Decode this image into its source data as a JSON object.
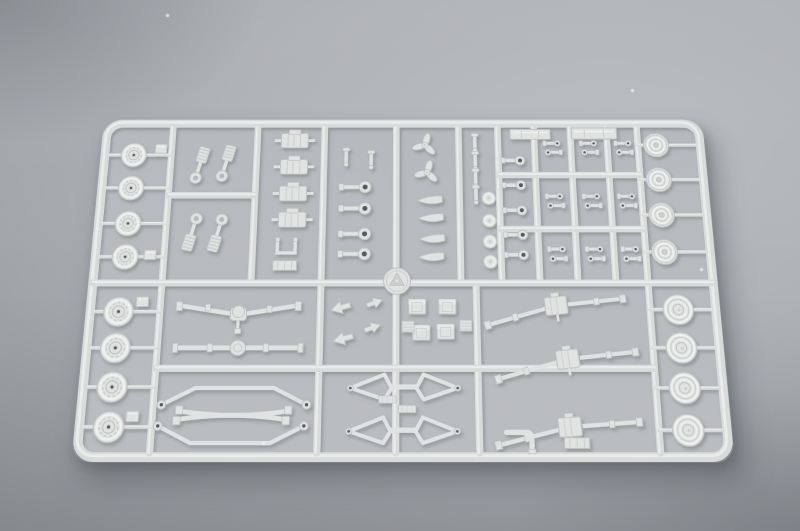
{
  "photo": {
    "description": "Light grey injection-moulded plastic model-kit sprue photographed at a slight angle on a grey studio surface; the runner frame holds columns of road wheels along both edges and rows of suspension parts: coil-spring shock absorbers, gearbox blocks, linkage arms, propeller and blade pieces, discs, clevis fittings, drive axles with differentials, leaf-spring assemblies, wishbone lattices, transfer cases and small stowage boxes, with a round medallion part at the centre junction.",
    "background": {
      "highlight": "#b8bbbf",
      "mid": "#aeb1b6",
      "low": "#a2a5aa",
      "dark": "#92959a"
    },
    "plastic": {
      "base": "#e0e3e1",
      "light": "#eff1ef",
      "mid": "#cdd0ce",
      "shade": "#c0c3c1",
      "hole": "#555860",
      "runner": "#d8dbd9",
      "runner_highlight": "#ecefec",
      "interior_top": "#b6b9bd",
      "interior_bottom": "#babdc0",
      "shadow": "#70747a"
    },
    "specks": [
      {
        "x": 166,
        "y": 14
      },
      {
        "x": 631,
        "y": 89
      },
      {
        "x": 262,
        "y": 442
      },
      {
        "x": 700,
        "y": 268
      }
    ]
  },
  "sprue": {
    "frame": {
      "x": 5,
      "y": 5,
      "width": 620,
      "height": 340,
      "radius": 16,
      "thickness": 9
    },
    "runner_width": 7,
    "gate_width": 3.5,
    "runners": {
      "vertical": [
        {
          "x": 74,
          "y1": 9,
          "y2": 341
        },
        {
          "x": 233,
          "y1": 9,
          "y2": 341
        },
        {
          "x": 308,
          "y1": 9,
          "y2": 341
        },
        {
          "x": 560,
          "y1": 9,
          "y2": 341
        },
        {
          "x": 163,
          "y1": 9,
          "y2": 176
        },
        {
          "x": 373,
          "y1": 9,
          "y2": 176
        },
        {
          "x": 414,
          "y1": 9,
          "y2": 176
        },
        {
          "x": 452,
          "y1": 9,
          "y2": 176
        },
        {
          "x": 490,
          "y1": 9,
          "y2": 176
        },
        {
          "x": 528,
          "y1": 9,
          "y2": 176
        },
        {
          "x": 388,
          "y1": 176,
          "y2": 341
        }
      ],
      "horizontal": [
        {
          "y": 176,
          "x1": 5,
          "x2": 625
        },
        {
          "y": 261,
          "x1": 74,
          "x2": 560
        },
        {
          "y": 62,
          "x1": 414,
          "x2": 560
        },
        {
          "y": 120,
          "x1": 414,
          "x2": 560
        },
        {
          "y": 84,
          "x1": 74,
          "x2": 163
        }
      ],
      "gates": [
        {
          "y": 40,
          "x1": 9,
          "x2": 74
        },
        {
          "y": 76,
          "x1": 9,
          "x2": 74
        },
        {
          "y": 114,
          "x1": 9,
          "x2": 74
        },
        {
          "y": 149,
          "x1": 9,
          "x2": 74
        },
        {
          "y": 29,
          "x1": 560,
          "x2": 621
        },
        {
          "y": 67,
          "x1": 560,
          "x2": 621
        },
        {
          "y": 105,
          "x1": 560,
          "x2": 621
        },
        {
          "y": 144,
          "x1": 560,
          "x2": 621
        },
        {
          "y": 205,
          "x1": 9,
          "x2": 74
        },
        {
          "y": 241,
          "x1": 9,
          "x2": 74
        },
        {
          "y": 279,
          "x1": 9,
          "x2": 74
        },
        {
          "y": 317,
          "x1": 9,
          "x2": 74
        },
        {
          "y": 203,
          "x1": 560,
          "x2": 621
        },
        {
          "y": 241,
          "x1": 560,
          "x2": 621
        },
        {
          "y": 280,
          "x1": 560,
          "x2": 621
        },
        {
          "y": 320,
          "x1": 560,
          "x2": 621
        }
      ]
    },
    "parts": [
      {
        "t": "wheel_hub_sm",
        "x": 35,
        "y": 40
      },
      {
        "t": "wheel_hub_sm",
        "x": 35,
        "y": 76
      },
      {
        "t": "wheel_hub_sm",
        "x": 35,
        "y": 114
      },
      {
        "t": "wheel_hub_sm",
        "x": 35,
        "y": 149
      },
      {
        "t": "tab",
        "x": 63,
        "y": 33
      },
      {
        "t": "tab",
        "x": 60,
        "y": 147
      },
      {
        "t": "shock",
        "x": 104,
        "y": 52,
        "r": 14
      },
      {
        "t": "shock",
        "x": 131,
        "y": 50,
        "r": 14
      },
      {
        "t": "shock",
        "x": 101,
        "y": 122,
        "r": 194
      },
      {
        "t": "shock",
        "x": 127,
        "y": 123,
        "r": 194
      },
      {
        "t": "gearbox",
        "x": 202,
        "y": 24
      },
      {
        "t": "gearbox",
        "x": 202,
        "y": 53
      },
      {
        "t": "gearbox",
        "x": 202,
        "y": 82
      },
      {
        "t": "gearbox",
        "x": 202,
        "y": 110
      },
      {
        "t": "bracket",
        "x": 197,
        "y": 139
      },
      {
        "t": "plate_sm",
        "x": 196,
        "y": 158
      },
      {
        "t": "peg_v",
        "x": 256,
        "y": 42
      },
      {
        "t": "peg_v",
        "x": 282,
        "y": 45
      },
      {
        "t": "arm",
        "x": 266,
        "y": 75
      },
      {
        "t": "arm",
        "x": 266,
        "y": 98
      },
      {
        "t": "arm",
        "x": 266,
        "y": 125
      },
      {
        "t": "arm",
        "x": 266,
        "y": 146
      },
      {
        "t": "prop",
        "x": 338,
        "y": 29
      },
      {
        "t": "prop",
        "x": 340,
        "y": 59
      },
      {
        "t": "blade",
        "x": 343,
        "y": 89
      },
      {
        "t": "blade",
        "x": 344,
        "y": 108
      },
      {
        "t": "blade",
        "x": 345,
        "y": 130
      },
      {
        "t": "blade",
        "x": 344,
        "y": 149
      },
      {
        "t": "peg_v",
        "x": 390,
        "y": 26
      },
      {
        "t": "peg_v",
        "x": 390,
        "y": 46
      },
      {
        "t": "peg_v",
        "x": 390,
        "y": 65
      },
      {
        "t": "peg_v",
        "x": 390,
        "y": 83
      },
      {
        "t": "disc",
        "x": 403,
        "y": 87
      },
      {
        "t": "disc",
        "x": 403,
        "y": 111
      },
      {
        "t": "disc",
        "x": 403,
        "y": 133
      },
      {
        "t": "disc",
        "x": 403,
        "y": 154
      },
      {
        "t": "plate_top",
        "x": 448,
        "y": 17
      },
      {
        "t": "plate_top",
        "x": 515,
        "y": 16,
        "s": 1.12
      },
      {
        "t": "rodend",
        "x": 430,
        "y": 46
      },
      {
        "t": "rodend",
        "x": 430,
        "y": 73
      },
      {
        "t": "rodend",
        "x": 430,
        "y": 100
      },
      {
        "t": "rodend",
        "x": 430,
        "y": 126
      },
      {
        "t": "rodend",
        "x": 430,
        "y": 147
      },
      {
        "t": "clevis2",
        "x": 471,
        "y": 32
      },
      {
        "t": "clevis2",
        "x": 509,
        "y": 32
      },
      {
        "t": "clevis2",
        "x": 545,
        "y": 32
      },
      {
        "t": "clevis2",
        "x": 471,
        "y": 90
      },
      {
        "t": "clevis2",
        "x": 509,
        "y": 90
      },
      {
        "t": "clevis2",
        "x": 545,
        "y": 90
      },
      {
        "t": "clevis2",
        "x": 471,
        "y": 146
      },
      {
        "t": "clevis2",
        "x": 509,
        "y": 146
      },
      {
        "t": "clevis2",
        "x": 545,
        "y": 146
      },
      {
        "t": "wheel_drum",
        "x": 579,
        "y": 29
      },
      {
        "t": "wheel_drum",
        "x": 579,
        "y": 67
      },
      {
        "t": "wheel_drum",
        "x": 579,
        "y": 105
      },
      {
        "t": "wheel_drum",
        "x": 579,
        "y": 144
      },
      {
        "t": "emblem",
        "x": 309,
        "y": 174
      },
      {
        "t": "wheel_hub_lg",
        "x": 33,
        "y": 205
      },
      {
        "t": "wheel_hub_lg",
        "x": 33,
        "y": 241
      },
      {
        "t": "wheel_hub_lg",
        "x": 33,
        "y": 279
      },
      {
        "t": "wheel_hub_lg",
        "x": 33,
        "y": 317
      },
      {
        "t": "tab",
        "x": 56,
        "y": 195
      },
      {
        "t": "tab",
        "x": 55,
        "y": 307
      },
      {
        "t": "axle_v",
        "x": 152,
        "y": 205
      },
      {
        "t": "axle_s",
        "x": 153,
        "y": 241
      },
      {
        "t": "arrow",
        "x": 253,
        "y": 201,
        "r": -15
      },
      {
        "t": "arrow",
        "x": 256,
        "y": 232,
        "r": -15
      },
      {
        "t": "arrow",
        "x": 287,
        "y": 196,
        "r": 160,
        "s": 0.82
      },
      {
        "t": "arrow",
        "x": 285,
        "y": 221,
        "r": 160,
        "s": 0.82
      },
      {
        "t": "box_big",
        "x": 329,
        "y": 200
      },
      {
        "t": "box_big",
        "x": 359,
        "y": 200
      },
      {
        "t": "box_big",
        "x": 333,
        "y": 226
      },
      {
        "t": "box_big",
        "x": 357,
        "y": 225
      },
      {
        "t": "box_sm",
        "x": 320,
        "y": 220
      },
      {
        "t": "box_sm",
        "x": 377,
        "y": 219
      },
      {
        "t": "transfer",
        "x": 467,
        "y": 199,
        "r": -6
      },
      {
        "t": "transfer",
        "x": 476,
        "y": 252,
        "r": -6
      },
      {
        "t": "transfer",
        "x": 475,
        "y": 317,
        "r": -4
      },
      {
        "t": "leaf",
        "x": 152,
        "y": 289
      },
      {
        "t": "leaf",
        "x": 150,
        "y": 323,
        "r": 180
      },
      {
        "t": "diamond",
        "x": 316,
        "y": 279
      },
      {
        "t": "diamond",
        "x": 315,
        "y": 320
      },
      {
        "t": "plate_sm",
        "x": 300,
        "y": 291,
        "s": 0.7
      },
      {
        "t": "plate_sm",
        "x": 319,
        "y": 300,
        "s": 0.7
      },
      {
        "t": "elbow",
        "x": 427,
        "y": 330
      },
      {
        "t": "plate_sm",
        "x": 481,
        "y": 332
      },
      {
        "t": "wheel_cap_lg",
        "x": 588,
        "y": 203
      },
      {
        "t": "wheel_cap_lg",
        "x": 588,
        "y": 241
      },
      {
        "t": "wheel_cap_lg",
        "x": 588,
        "y": 280
      },
      {
        "t": "wheel_cap_lg",
        "x": 588,
        "y": 320
      }
    ]
  }
}
